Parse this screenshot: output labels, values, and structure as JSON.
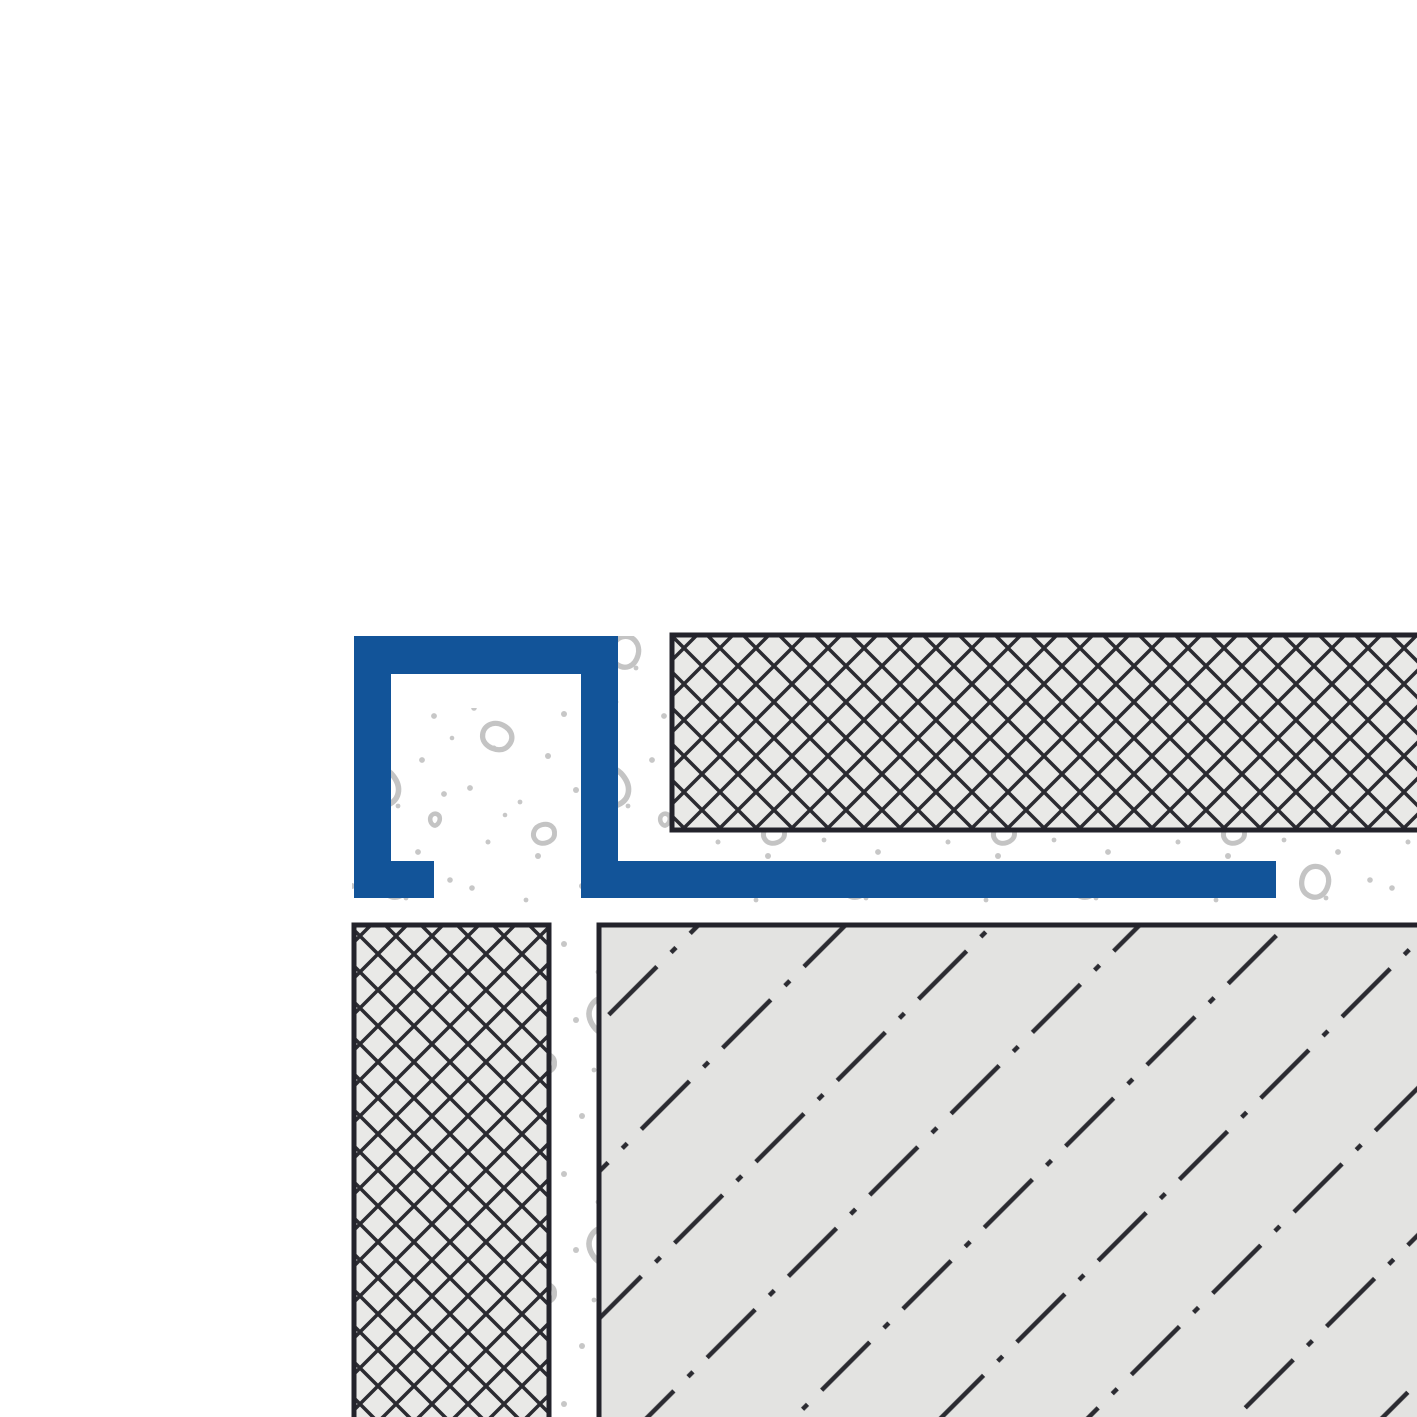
{
  "colors": {
    "background": "#ffffff",
    "profile_blue": "#125499",
    "outline_dark": "#23232b",
    "hatch_dark": "#2b2b31",
    "tile_fill": "#e9e9e7",
    "substrate_fill": "#e3e3e1",
    "mortar_bg": "#ffffff",
    "speckle_gray": "#c7c7c7",
    "pebble_gray": "#c4c4c4"
  },
  "components": {
    "profile": "square-edge-profile",
    "profile_leg": "anchoring-leg",
    "tile_top": "tile-crosshatch",
    "tile_left": "tile-crosshatch",
    "substrate": "screed-substrate",
    "mortar": "thin-set-mortar-bed"
  }
}
